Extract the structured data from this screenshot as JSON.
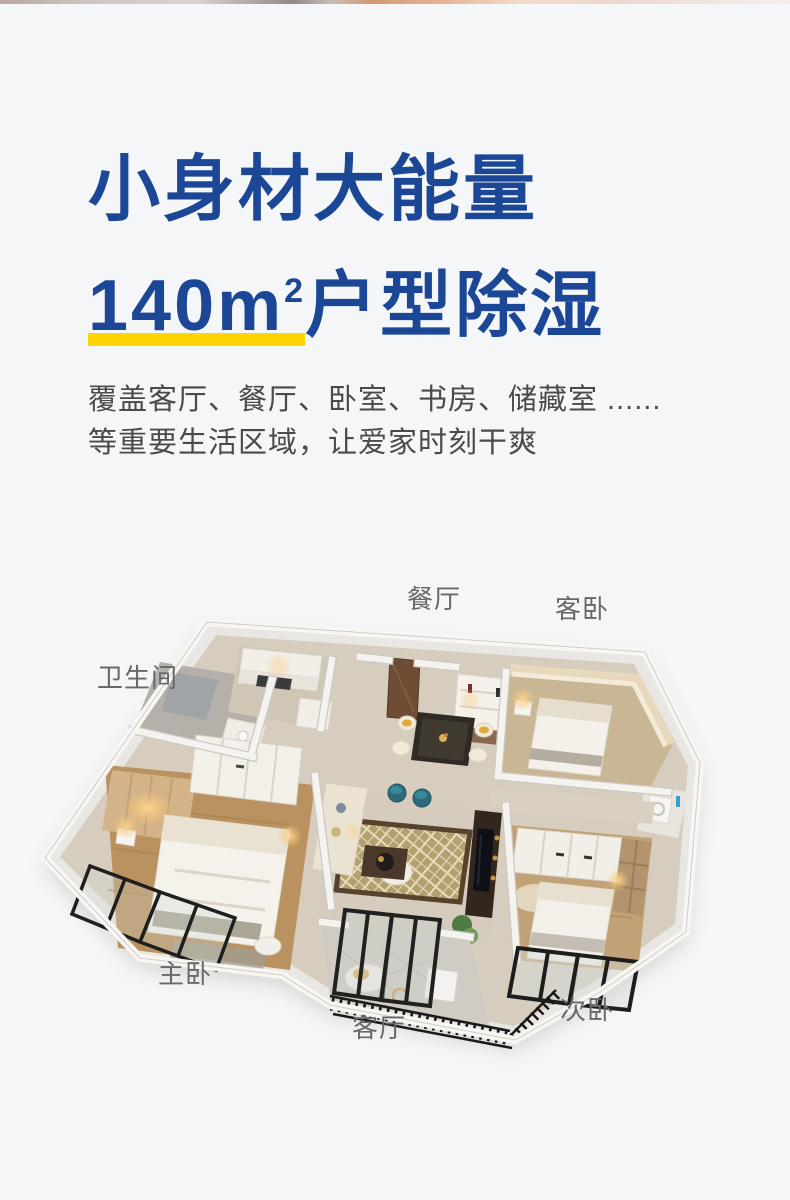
{
  "page": {
    "background": "#f5f6f7"
  },
  "hero": {
    "title_line1": "小身材大能量",
    "title_area_value": "140m",
    "title_area_sup": "2",
    "title_line2_rest": "户型除湿",
    "subtitle_line1": "覆盖客厅、餐厅、卧室、书房、储藏室 ......",
    "subtitle_line2": "等重要生活区域，让爱家时刻干爽",
    "colors": {
      "title_blue": "#1b4796",
      "underline_yellow": "#ffd400",
      "subtitle_gray": "#4a4a4a"
    }
  },
  "floorplan": {
    "label_color": "#67686b",
    "labels": {
      "dining": "餐厅",
      "guest_bedroom": "客卧",
      "bathroom": "卫生间",
      "master_bedroom": "主卧",
      "living_room": "客厅",
      "second_bedroom": "次卧"
    }
  }
}
